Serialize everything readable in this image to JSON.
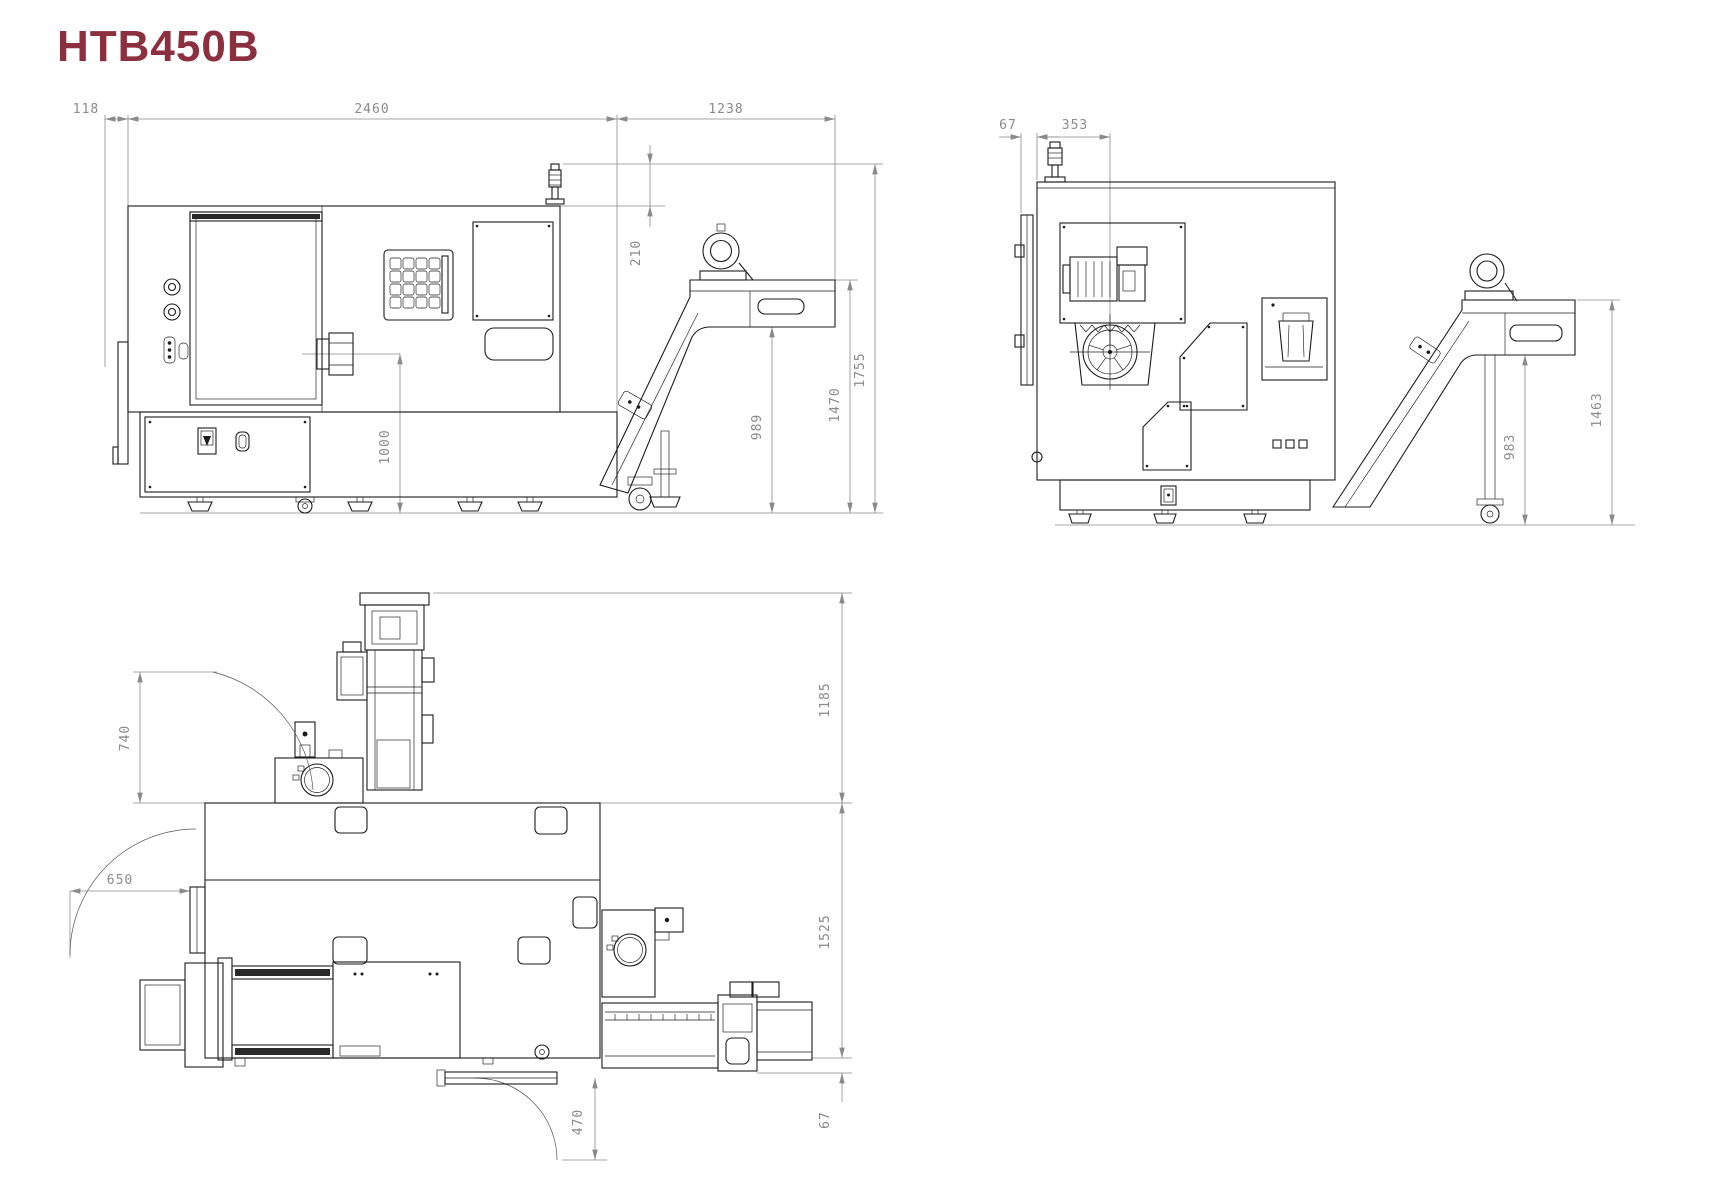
{
  "page": {
    "title": "HTB450B",
    "title_color": "#8c2f3e",
    "background": "#ffffff",
    "line_color": "#1b1b1b",
    "dim_color": "#8a8a8a"
  },
  "front_view": {
    "dims": {
      "left_offset": "118",
      "overall_length": "2460",
      "conveyor_overhang": "1238",
      "lamp_height": "210",
      "spindle_center_height": "1000",
      "discharge_underpass_height": "989",
      "discharge_height": "1470",
      "overall_height": "1755"
    }
  },
  "side_view": {
    "dims": {
      "door_offset": "67",
      "spindle_center_depth": "353",
      "discharge_underpass_height": "983",
      "discharge_height": "1463"
    }
  },
  "top_view": {
    "dims": {
      "front_door_opening": "740",
      "left_door_swing": "650",
      "conveyor_overhang": "1185",
      "overall_depth": "1525",
      "front_door_swing": "470",
      "front_lip": "67"
    }
  }
}
